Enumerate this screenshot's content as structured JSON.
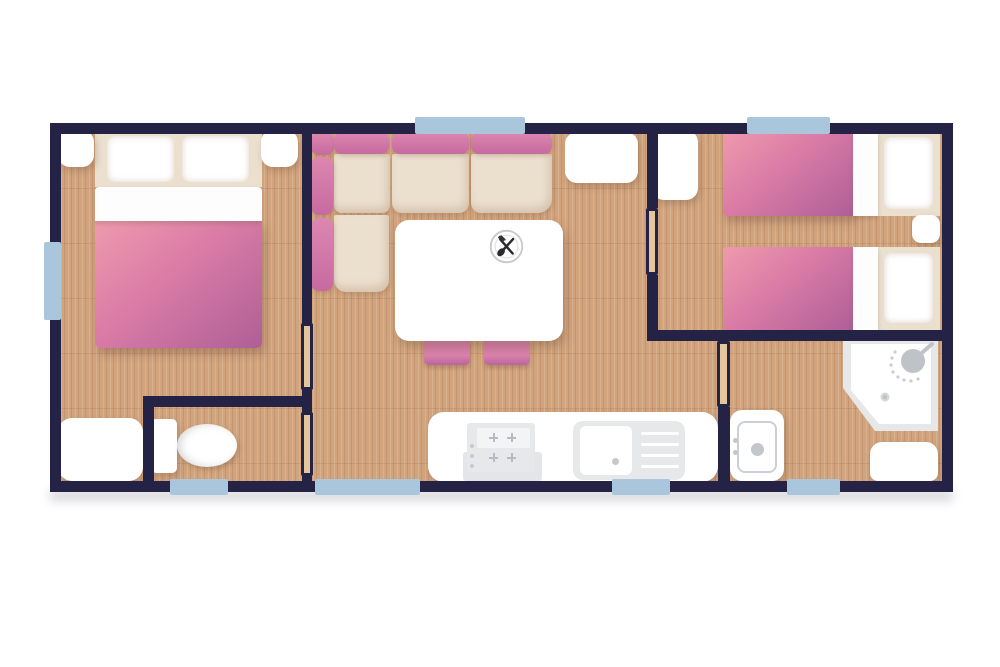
{
  "palette": {
    "background": "#ffffff",
    "wall": "#242346",
    "window": "#a9c6dc",
    "floor": "#d2a47d",
    "cream": "#ebdfce",
    "furniture_white": "#ffffff",
    "appliance_gray": "#e7e8ea",
    "door_fill": "#e5c69c",
    "duvet_light": "#ef9aad",
    "duvet_dark": "#ae5f97",
    "sofa_pink": "#d27aa8",
    "utensil_black": "#2a2a30"
  },
  "floor_plan": {
    "type": "floor-plan",
    "rooms": [
      {
        "name": "double-bedroom",
        "furniture": [
          "double-bed",
          "pillow",
          "pillow",
          "nightstand-left",
          "nightstand-right",
          "wardrobe"
        ]
      },
      {
        "name": "wc",
        "furniture": [
          "toilet"
        ]
      },
      {
        "name": "living-kitchen",
        "furniture": [
          "corner-sofa",
          "dining-table",
          "plate-with-cutlery",
          "chair",
          "chair",
          "wardrobe",
          "kitchen-counter",
          "stove",
          "sink-with-drainer"
        ]
      },
      {
        "name": "twin-bedroom",
        "furniture": [
          "twin-bed",
          "twin-bed",
          "nightstand",
          "wardrobe"
        ]
      },
      {
        "name": "shower-room",
        "furniture": [
          "corner-shower",
          "washbasin",
          "cabinet"
        ]
      }
    ],
    "window_count": 7,
    "door_count": 4
  }
}
